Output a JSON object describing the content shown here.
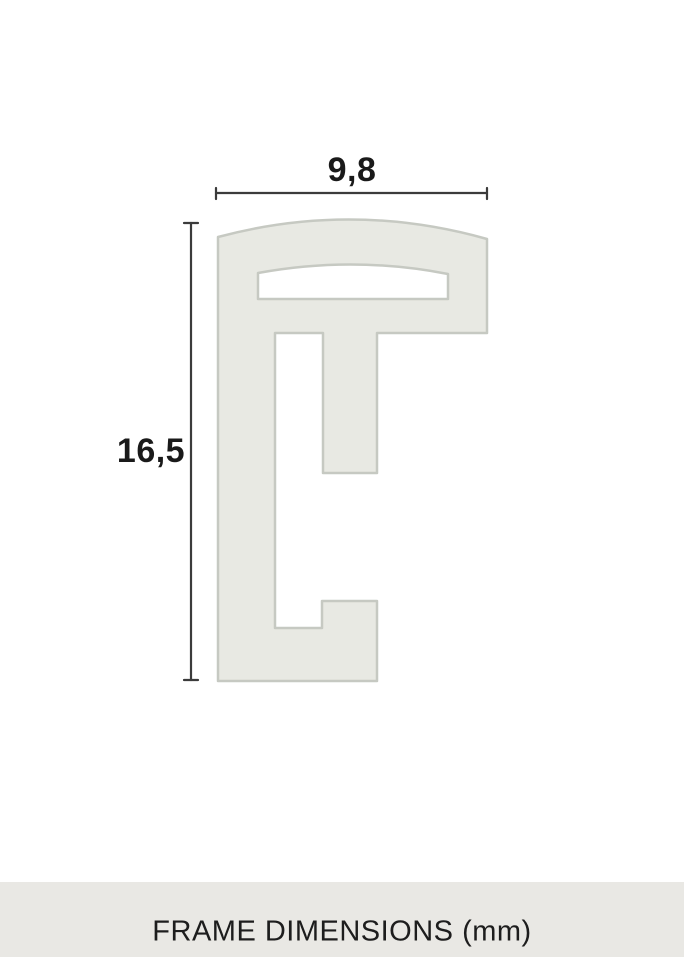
{
  "diagram": {
    "width_label": "9,8",
    "height_label": "16,5"
  },
  "footer": {
    "label": "FRAME DIMENSIONS (mm)"
  },
  "colors": {
    "profile_fill": "#e8e9e3",
    "profile_stroke": "#c6c9c2",
    "dimension_line": "#3b3b3b",
    "label_text": "#1a1a1a",
    "footer_background": "#e9e8e4",
    "footer_text": "#1d1d1d",
    "page_background": "#ffffff"
  }
}
